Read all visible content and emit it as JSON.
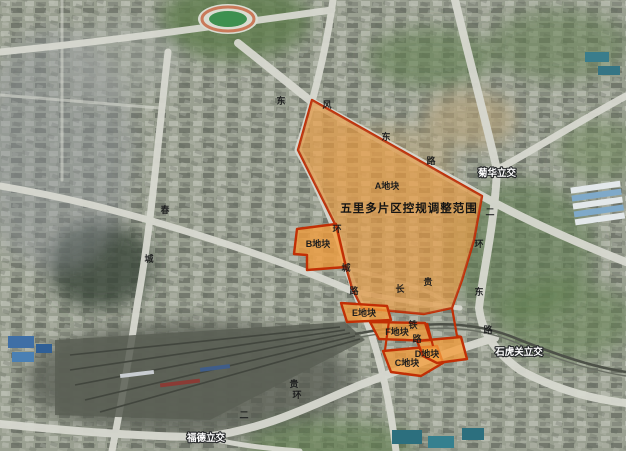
{
  "map": {
    "title": {
      "text": "五里多片区控规调整范围",
      "x": 409,
      "y": 212
    },
    "parcels": [
      {
        "id": "A",
        "label": "A地块",
        "x": 387,
        "y": 189
      },
      {
        "id": "B",
        "label": "B地块",
        "x": 318,
        "y": 247
      },
      {
        "id": "C",
        "label": "C地块",
        "x": 407,
        "y": 366
      },
      {
        "id": "D",
        "label": "D地块",
        "x": 427,
        "y": 357
      },
      {
        "id": "E",
        "label": "E地块",
        "x": 364,
        "y": 316
      },
      {
        "id": "F",
        "label": "F地块",
        "x": 397,
        "y": 335
      }
    ],
    "interchanges": [
      {
        "label": "菊华立交",
        "x": 497,
        "y": 176
      },
      {
        "label": "石虎关立交",
        "x": 519,
        "y": 355
      },
      {
        "label": "福德立交",
        "x": 206,
        "y": 441
      }
    ],
    "road_chars": [
      {
        "ch": "东",
        "x": 281,
        "y": 104
      },
      {
        "ch": "风",
        "x": 327,
        "y": 108
      },
      {
        "ch": "东",
        "x": 386,
        "y": 140
      },
      {
        "ch": "路",
        "x": 431,
        "y": 164
      },
      {
        "ch": "二",
        "x": 490,
        "y": 215
      },
      {
        "ch": "环",
        "x": 479,
        "y": 247
      },
      {
        "ch": "东",
        "x": 479,
        "y": 295
      },
      {
        "ch": "路",
        "x": 488,
        "y": 333
      },
      {
        "ch": "春",
        "x": 165,
        "y": 213
      },
      {
        "ch": "城",
        "x": 149,
        "y": 262
      },
      {
        "ch": "环",
        "x": 337,
        "y": 232
      },
      {
        "ch": "城",
        "x": 346,
        "y": 271
      },
      {
        "ch": "路",
        "x": 354,
        "y": 294
      },
      {
        "ch": "长",
        "x": 400,
        "y": 292
      },
      {
        "ch": "贵",
        "x": 428,
        "y": 285
      },
      {
        "ch": "铁",
        "x": 413,
        "y": 328
      },
      {
        "ch": "路",
        "x": 417,
        "y": 342
      },
      {
        "ch": "贵",
        "x": 294,
        "y": 387
      },
      {
        "ch": "环",
        "x": 297,
        "y": 398
      },
      {
        "ch": "二",
        "x": 244,
        "y": 418
      }
    ],
    "colors": {
      "parcel_fill": "#f49d3c",
      "parcel_border": "#c22f05",
      "label_text": "#1d1d1d",
      "interchange_text": "#ffffff",
      "road_light": "#d7d9d0"
    }
  }
}
